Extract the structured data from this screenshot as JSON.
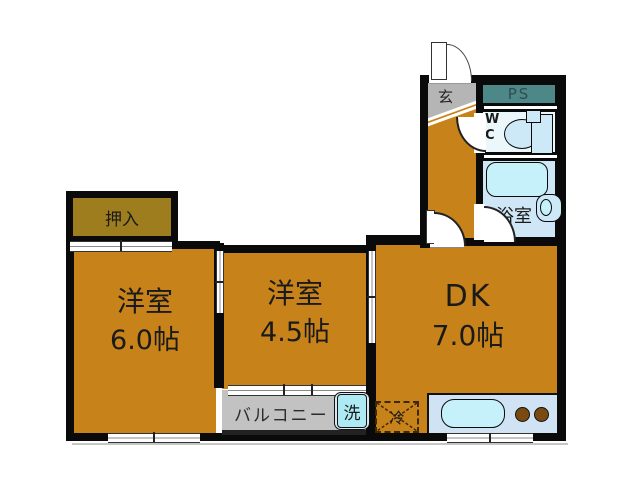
{
  "plan_type": "apartment-floor-plan",
  "rooms": {
    "closet": {
      "label": "押入"
    },
    "western_room_large": {
      "label": "洋室",
      "size": "6.0帖"
    },
    "western_room_small": {
      "label": "洋室",
      "size": "4.5帖"
    },
    "dining_kitchen": {
      "label": "DK",
      "size": "7.0帖"
    },
    "balcony": {
      "label": "バルコニー"
    },
    "entrance": {
      "label": "玄"
    },
    "pipe_space": {
      "label": "PS"
    },
    "toilet": {
      "label_line1": "W",
      "label_line2": "C"
    },
    "bathroom": {
      "label": "浴室"
    }
  },
  "fixtures": {
    "washing_machine": {
      "label": "洗"
    },
    "refrigerator": {
      "label": "冷"
    }
  },
  "icons": {
    "entrance-door-swing-icon": "quarter-arc",
    "door-swing-icon": "white-quarter-disc",
    "genkan-step-icon": "double-diagonal-lines",
    "toilet-icon": "ellipse-bowl-with-tank",
    "bathtub-icon": "rounded-rect",
    "washbasin-icon": "rounded-rect-with-oval",
    "kitchen-sink-icon": "rounded-rect",
    "stove-burners-icon": "two-dots",
    "refrigerator-cross-icon": "dashed-x"
  },
  "colors": {
    "wall": "#0A0A0A",
    "room": "#C8821A",
    "closet": "#9E7D1E",
    "genkan": "#B5B5B5",
    "balcony": "#C2C2C2",
    "ps": "#4E8787",
    "wc": "#ECF7FB",
    "bath": "#CFE6F7",
    "tub": "#C6F0FA",
    "fixture": "#CDE9F8",
    "counter": "#CFE3F4",
    "washer": "#AEEAF4",
    "burner": "#7B4A10"
  }
}
